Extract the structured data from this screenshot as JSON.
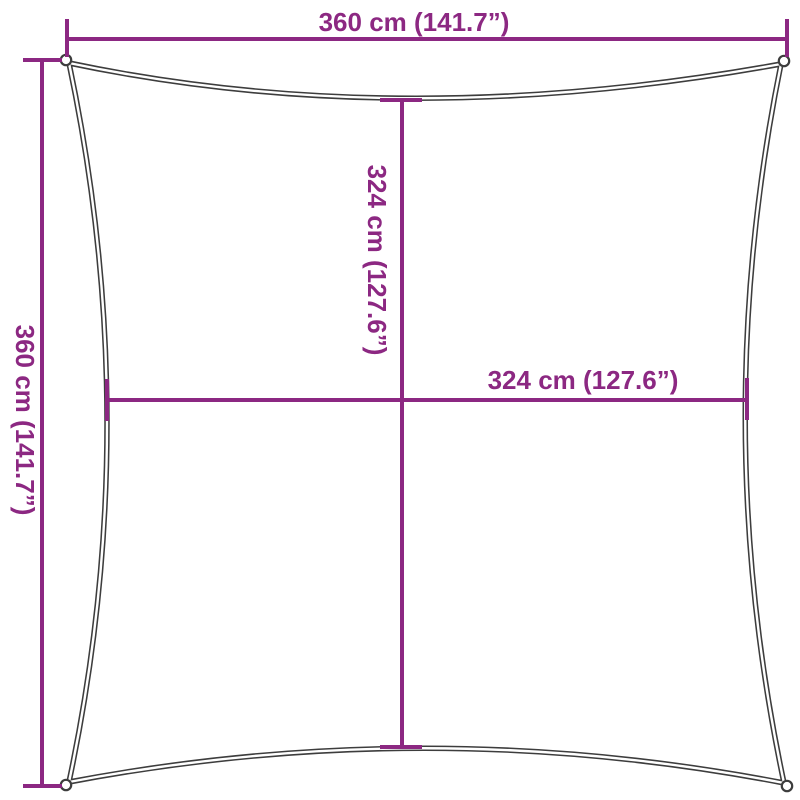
{
  "diagram": {
    "labels": {
      "width_top": "360 cm (141.7”)",
      "height_left": "360 cm (141.7”)",
      "inner_height": "324 cm (127.6”)",
      "inner_width": "324 cm (127.6”)"
    },
    "colors": {
      "dimension_accent": "#8C2882",
      "sail_outline": "#3D3D3D",
      "background": "#FFFFFF"
    }
  }
}
